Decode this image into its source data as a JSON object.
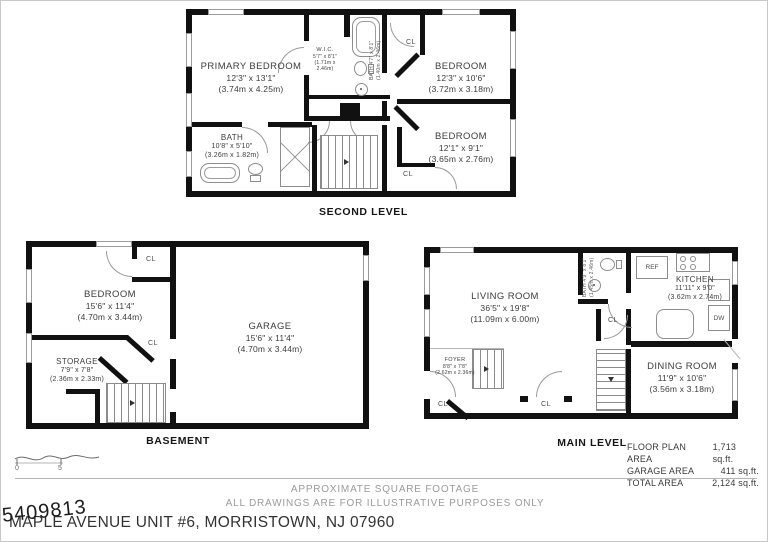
{
  "levels": {
    "second": {
      "title": "SECOND LEVEL",
      "rooms": {
        "primary": {
          "name": "PRIMARY BEDROOM",
          "imperial": "12'3\" x 13'1\"",
          "metric": "(3.74m x 4.25m)"
        },
        "wic": {
          "name": "W.I.C.",
          "imperial": "5'7\" x 8'1\"",
          "metric": "(1.71m x 2.46m)"
        },
        "bath_upper": {
          "name": "BATH",
          "imperial": "4'7\" x 8'1\"",
          "metric": "(1.40m x 2.46m)"
        },
        "bedroom_tr": {
          "name": "BEDROOM",
          "imperial": "12'3\" x 10'6\"",
          "metric": "(3.72m x 3.18m)"
        },
        "bedroom_mr": {
          "name": "BEDROOM",
          "imperial": "12'1\" x 9'1\"",
          "metric": "(3.65m x 2.76m)"
        },
        "bath_main": {
          "name": "BATH",
          "imperial": "10'8\" x 5'10\"",
          "metric": "(3.26m x 1.82m)"
        }
      }
    },
    "basement": {
      "title": "BASEMENT",
      "rooms": {
        "bedroom": {
          "name": "BEDROOM",
          "imperial": "15'6\" x 11'4\"",
          "metric": "(4.70m x 3.44m)"
        },
        "storage": {
          "name": "STORAGE",
          "imperial": "7'9\" x 7'8\"",
          "metric": "(2.36m x 2.33m)"
        },
        "garage": {
          "name": "GARAGE",
          "imperial": "15'6\" x 11'4\"",
          "metric": "(4.70m x 3.44m)"
        }
      }
    },
    "main": {
      "title": "MAIN LEVEL",
      "rooms": {
        "living": {
          "name": "LIVING ROOM",
          "imperial": "36'5\" x 19'8\"",
          "metric": "(11.09m x 6.00m)"
        },
        "kitchen": {
          "name": "KITCHEN",
          "imperial": "11'11\" x 9'0\"",
          "metric": "(3.62m x 2.74m)"
        },
        "dining": {
          "name": "DINING ROOM",
          "imperial": "11'9\" x 10'6\"",
          "metric": "(3.56m x 3.18m)"
        },
        "foyer": {
          "name": "FOYER",
          "imperial": "8'8\" x 7'8\"",
          "metric": "(2.62m x 2.36m)"
        },
        "bath": {
          "name": "BATH",
          "imperial": "4'9\" x 8'1\"",
          "metric": "(1.45m x 2.46m)"
        }
      }
    }
  },
  "labels": {
    "cl": "CL",
    "ref": "REF",
    "dw": "DW"
  },
  "area_table": {
    "rows": [
      {
        "label": "FLOOR PLAN AREA",
        "value": "1,713 sq.ft."
      },
      {
        "label": "GARAGE AREA",
        "value": "411 sq.ft."
      },
      {
        "label": "TOTAL AREA",
        "value": "2,124 sq.ft."
      }
    ]
  },
  "scale_bar": {
    "zero": "0",
    "five": "5"
  },
  "footer": {
    "line1": "APPROXIMATE SQUARE FOOTAGE",
    "line2": "ALL DRAWINGS ARE FOR ILLUSTRATIVE PURPOSES ONLY",
    "address": "MAPLE AVENUE UNIT #6, MORRISTOWN, NJ 07960",
    "mls_number": "5409813"
  }
}
